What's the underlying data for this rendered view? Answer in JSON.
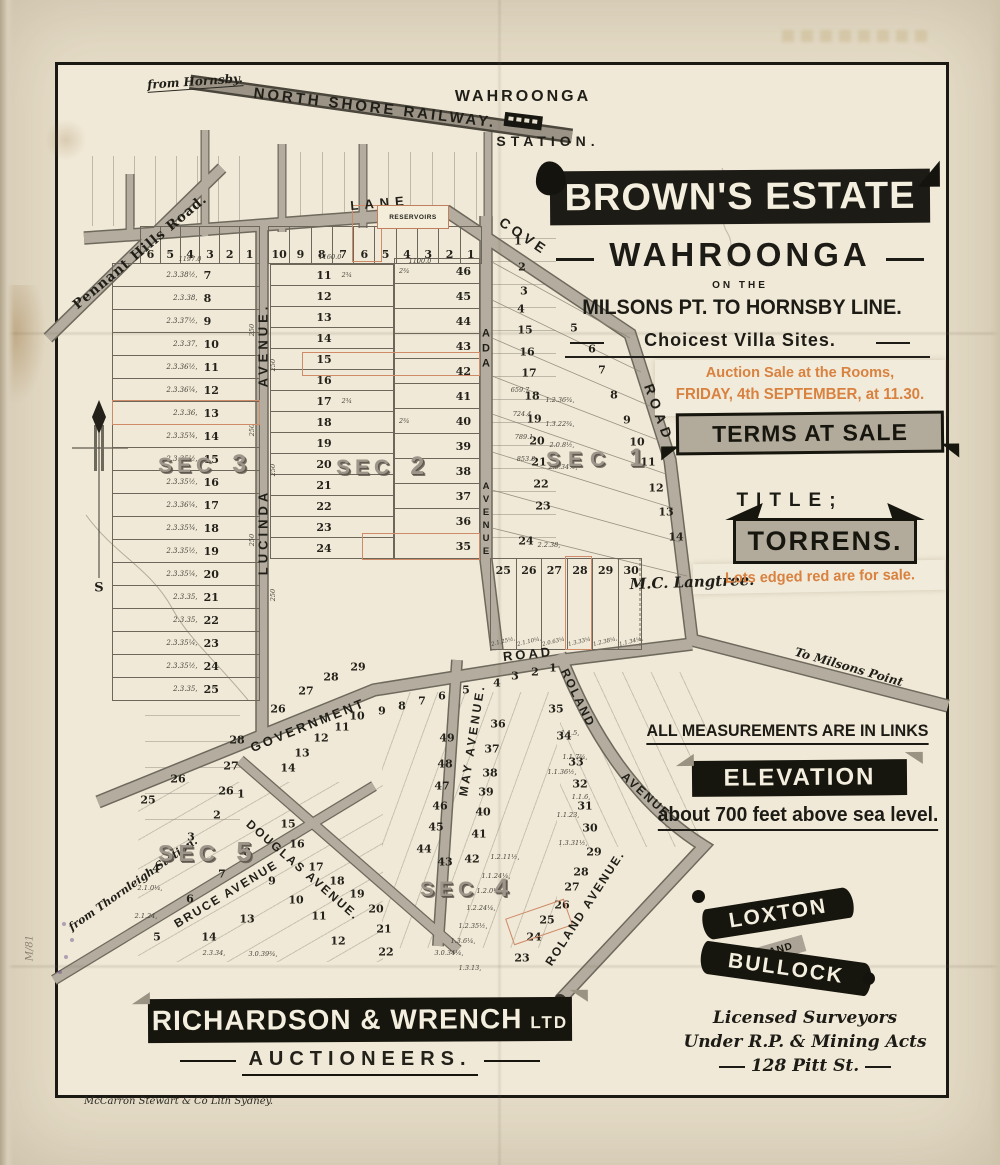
{
  "header": {
    "from_hornsby": "from Hornsby.",
    "railway": "NORTH SHORE RAILWAY.",
    "station_place": "WAHROONGA",
    "station_word": "STATION."
  },
  "title_block": {
    "estate": "BROWN'S ESTATE",
    "locality": "WAHROONGA",
    "on_the": "ON THE",
    "line": "MILSONS PT. TO HORNSBY LINE.",
    "villa": "Choicest Villa Sites.",
    "auction1": "Auction Sale at the Rooms,",
    "auction2": "FRIDAY, 4th SEPTEMBER, at 11.30.",
    "terms": "TERMS AT SALE",
    "title_word": "TITLE;",
    "torrens": "TORRENS.",
    "lots_red": "Lots edged red are for sale.",
    "accent_color": "#d9813f"
  },
  "notes": {
    "measurements": "ALL MEASUREMENTS ARE IN LINKS",
    "elevation_banner": "ELEVATION",
    "elevation_text": "about 700 feet above sea level."
  },
  "surveyors": {
    "name1": "LOXTON",
    "and": "AND",
    "name2": "BULLOCK",
    "line1": "Licensed Surveyors",
    "line2": "Under R.P. & Mining Acts",
    "line3": "128 Pitt St."
  },
  "auctioneers": {
    "firm": "RICHARDSON & WRENCH",
    "suffix": "LTD",
    "role": "AUCTIONEERS."
  },
  "imprint": "McCarron Stewart & Co Lith Sydney.",
  "margin_note": "M/81",
  "compass": {
    "south": "S"
  },
  "landowner": "M.C. Langtree.",
  "roads": {
    "pennant": "Pennant Hills Road.",
    "lane": "LANE",
    "cove": "COVE",
    "road": "ROAD",
    "milsons": "To Milsons Point",
    "lucinda1": "LUCINDA",
    "lucinda2": "AVENUE.",
    "ada1": "ADA",
    "ada2": "AVENUE",
    "government": "GOVERNMENT",
    "gov_road": "ROAD",
    "may": "MAY AVENUE.",
    "roland_a": "ROLAND",
    "roland_b": "AVENUE",
    "roland2": "ROLAND AVENUE.",
    "bruce": "BRUCE AVENUE",
    "douglas": "DOUGLAS AVENUE.",
    "thornleigh": "from Thornleigh Station.",
    "reservoirs": "RESERVOIRS"
  },
  "sections": {
    "s1": {
      "word": "SEC",
      "num": "1"
    },
    "s2": {
      "word": "SEC",
      "num": "2"
    },
    "s3": {
      "word": "SEC",
      "num": "3"
    },
    "s4": {
      "word": "SEC",
      "num": "4"
    },
    "s5": {
      "word": "SEC",
      "num": "5"
    }
  },
  "ghost": {
    "line1": "WAHROONGA",
    "line2": "BROWN'S ESTATE"
  },
  "lots": {
    "strip_left": [
      {
        "n": "6"
      },
      {
        "n": "5"
      },
      {
        "n": "4"
      },
      {
        "n": "3"
      },
      {
        "n": "2"
      },
      {
        "n": "1"
      }
    ],
    "strip_mid": [
      {
        "n": "10"
      },
      {
        "n": "9"
      },
      {
        "n": "8"
      },
      {
        "n": "7"
      },
      {
        "n": "6"
      },
      {
        "n": "5"
      },
      {
        "n": "4"
      },
      {
        "n": "3"
      },
      {
        "n": "2"
      },
      {
        "n": "1"
      }
    ],
    "sec3_rows": [
      {
        "d": "2.3.38½,",
        "n": "7"
      },
      {
        "d": "2.3.38,",
        "n": "8"
      },
      {
        "d": "2.3.37½,",
        "n": "9"
      },
      {
        "d": "2.3.37,",
        "n": "10"
      },
      {
        "d": "2.3.36½,",
        "n": "11"
      },
      {
        "d": "2.3.36¼,",
        "n": "12"
      },
      {
        "d": "2.3.36,",
        "n": "13",
        "red": true
      },
      {
        "d": "2.3.35¾,",
        "n": "14"
      },
      {
        "d": "2.3.35½,",
        "n": "15"
      },
      {
        "d": "2.3.35½,",
        "n": "16"
      },
      {
        "d": "2.3.36¼,",
        "n": "17"
      },
      {
        "d": "2.3.35¾,",
        "n": "18"
      },
      {
        "d": "2.3.35½,",
        "n": "19"
      },
      {
        "d": "2.3.35¼,",
        "n": "20"
      },
      {
        "d": "2.3.35,",
        "n": "21"
      },
      {
        "d": "2.3.35,",
        "n": "22"
      },
      {
        "d": "2.3.35¼,",
        "n": "23"
      },
      {
        "d": "2.3.35½,",
        "n": "24"
      },
      {
        "d": "2.3.35,",
        "n": "25"
      }
    ],
    "sec2_rows": [
      {
        "n": "11",
        "d": "2¾"
      },
      {
        "n": "12"
      },
      {
        "n": "13"
      },
      {
        "n": "14"
      },
      {
        "n": "15"
      },
      {
        "n": "16"
      },
      {
        "n": "17",
        "d": "2¾"
      },
      {
        "n": "18"
      },
      {
        "n": "19"
      },
      {
        "n": "20"
      },
      {
        "n": "21"
      },
      {
        "n": "22"
      },
      {
        "n": "23"
      },
      {
        "n": "24"
      }
    ],
    "ada_col": [
      {
        "n": "46",
        "d": "2¾"
      },
      {
        "n": "45"
      },
      {
        "n": "44"
      },
      {
        "n": "43"
      },
      {
        "n": "42"
      },
      {
        "n": "41"
      },
      {
        "n": "40",
        "d": "2¾"
      },
      {
        "n": "39"
      },
      {
        "n": "38"
      },
      {
        "n": "37"
      },
      {
        "n": "36"
      },
      {
        "n": "35"
      }
    ],
    "row25_30": [
      {
        "n": "25",
        "d": "2.1.25½,"
      },
      {
        "n": "26",
        "d": "2.1.10¼,"
      },
      {
        "n": "27",
        "d": "2.0.63¼,"
      },
      {
        "n": "28",
        "d": "1.3.33¼,"
      },
      {
        "n": "29",
        "d": "1.2.38¼,"
      },
      {
        "n": "30",
        "d": "1.1.34¼,"
      }
    ],
    "sec1_scatter": [
      {
        "n": "1",
        "x": 518,
        "y": 241
      },
      {
        "n": "2",
        "x": 522,
        "y": 267
      },
      {
        "n": "3",
        "x": 524,
        "y": 291
      },
      {
        "n": "4",
        "x": 521,
        "y": 309
      },
      {
        "n": "15",
        "x": 525,
        "y": 330
      },
      {
        "n": "16",
        "x": 527,
        "y": 352
      },
      {
        "n": "17",
        "x": 529,
        "y": 373
      },
      {
        "n": "18",
        "x": 532,
        "y": 396
      },
      {
        "n": "19",
        "x": 534,
        "y": 419
      },
      {
        "n": "20",
        "x": 537,
        "y": 441
      },
      {
        "n": "21",
        "x": 539,
        "y": 462
      },
      {
        "n": "22",
        "x": 541,
        "y": 484
      },
      {
        "n": "23",
        "x": 543,
        "y": 506
      },
      {
        "n": "24",
        "x": 526,
        "y": 541
      },
      {
        "n": "5",
        "x": 574,
        "y": 328
      },
      {
        "n": "6",
        "x": 592,
        "y": 349
      },
      {
        "n": "7",
        "x": 602,
        "y": 370
      },
      {
        "n": "8",
        "x": 614,
        "y": 395
      },
      {
        "n": "9",
        "x": 627,
        "y": 420
      },
      {
        "n": "10",
        "x": 637,
        "y": 442
      },
      {
        "n": "11",
        "x": 648,
        "y": 462
      },
      {
        "n": "12",
        "x": 656,
        "y": 488
      },
      {
        "n": "13",
        "x": 666,
        "y": 512
      },
      {
        "n": "14",
        "x": 676,
        "y": 537
      }
    ],
    "south_scatter": [
      {
        "n": "29",
        "x": 358,
        "y": 667
      },
      {
        "n": "28",
        "x": 331,
        "y": 677
      },
      {
        "n": "27",
        "x": 306,
        "y": 691
      },
      {
        "n": "26",
        "x": 278,
        "y": 709
      },
      {
        "n": "28",
        "x": 237,
        "y": 740
      },
      {
        "n": "27",
        "x": 231,
        "y": 766
      },
      {
        "n": "26",
        "x": 226,
        "y": 791
      },
      {
        "n": "1",
        "x": 553,
        "y": 668
      },
      {
        "n": "2",
        "x": 535,
        "y": 672
      },
      {
        "n": "3",
        "x": 515,
        "y": 676
      },
      {
        "n": "4",
        "x": 497,
        "y": 683
      },
      {
        "n": "5",
        "x": 466,
        "y": 690
      },
      {
        "n": "6",
        "x": 442,
        "y": 696
      },
      {
        "n": "7",
        "x": 422,
        "y": 701
      },
      {
        "n": "8",
        "x": 402,
        "y": 706
      },
      {
        "n": "9",
        "x": 382,
        "y": 711
      },
      {
        "n": "10",
        "x": 357,
        "y": 716
      },
      {
        "n": "11",
        "x": 342,
        "y": 727
      },
      {
        "n": "12",
        "x": 321,
        "y": 738
      },
      {
        "n": "13",
        "x": 302,
        "y": 753
      },
      {
        "n": "14",
        "x": 288,
        "y": 768
      },
      {
        "n": "49",
        "x": 447,
        "y": 738
      },
      {
        "n": "48",
        "x": 445,
        "y": 764
      },
      {
        "n": "47",
        "x": 442,
        "y": 786
      },
      {
        "n": "46",
        "x": 440,
        "y": 806
      },
      {
        "n": "45",
        "x": 436,
        "y": 827
      },
      {
        "n": "44",
        "x": 424,
        "y": 849
      },
      {
        "n": "43",
        "x": 445,
        "y": 862
      },
      {
        "n": "42",
        "x": 472,
        "y": 859
      },
      {
        "n": "41",
        "x": 479,
        "y": 834
      },
      {
        "n": "36",
        "x": 498,
        "y": 724
      },
      {
        "n": "37",
        "x": 492,
        "y": 749
      },
      {
        "n": "38",
        "x": 490,
        "y": 773
      },
      {
        "n": "39",
        "x": 486,
        "y": 792
      },
      {
        "n": "40",
        "x": 483,
        "y": 812
      },
      {
        "n": "35",
        "x": 556,
        "y": 709
      },
      {
        "n": "34",
        "x": 564,
        "y": 736
      },
      {
        "n": "33",
        "x": 576,
        "y": 762
      },
      {
        "n": "32",
        "x": 580,
        "y": 784
      },
      {
        "n": "31",
        "x": 585,
        "y": 806
      },
      {
        "n": "30",
        "x": 590,
        "y": 828
      },
      {
        "n": "29",
        "x": 594,
        "y": 852
      },
      {
        "n": "28",
        "x": 581,
        "y": 872
      },
      {
        "n": "27",
        "x": 572,
        "y": 887
      },
      {
        "n": "26",
        "x": 562,
        "y": 905
      },
      {
        "n": "25",
        "x": 547,
        "y": 920
      },
      {
        "n": "24",
        "x": 534,
        "y": 937
      },
      {
        "n": "23",
        "x": 522,
        "y": 958
      },
      {
        "n": "26",
        "x": 178,
        "y": 779
      },
      {
        "n": "25",
        "x": 148,
        "y": 800
      },
      {
        "n": "1",
        "x": 241,
        "y": 794
      },
      {
        "n": "2",
        "x": 217,
        "y": 815
      },
      {
        "n": "3",
        "x": 191,
        "y": 837
      },
      {
        "n": "4",
        "x": 156,
        "y": 869
      },
      {
        "n": "5",
        "x": 157,
        "y": 937
      },
      {
        "n": "6",
        "x": 190,
        "y": 899
      },
      {
        "n": "7",
        "x": 222,
        "y": 874
      },
      {
        "n": "8",
        "x": 247,
        "y": 852
      },
      {
        "n": "13",
        "x": 247,
        "y": 919
      },
      {
        "n": "14",
        "x": 209,
        "y": 937
      },
      {
        "n": "9",
        "x": 272,
        "y": 881
      },
      {
        "n": "10",
        "x": 296,
        "y": 900
      },
      {
        "n": "11",
        "x": 319,
        "y": 916
      },
      {
        "n": "12",
        "x": 338,
        "y": 941
      },
      {
        "n": "15",
        "x": 288,
        "y": 824
      },
      {
        "n": "16",
        "x": 297,
        "y": 844
      },
      {
        "n": "17",
        "x": 316,
        "y": 867
      },
      {
        "n": "18",
        "x": 337,
        "y": 881
      },
      {
        "n": "19",
        "x": 357,
        "y": 894
      },
      {
        "n": "20",
        "x": 376,
        "y": 909
      },
      {
        "n": "21",
        "x": 384,
        "y": 929
      },
      {
        "n": "22",
        "x": 386,
        "y": 952
      }
    ],
    "tiny_marks": [
      {
        "t": "1197.0",
        "x": 190,
        "y": 259
      },
      {
        "t": "1160.0",
        "x": 330,
        "y": 257
      },
      {
        "t": "1100.0",
        "x": 420,
        "y": 261
      },
      {
        "t": "659.7",
        "x": 520,
        "y": 390
      },
      {
        "t": "724.4",
        "x": 522,
        "y": 414
      },
      {
        "t": "789.1",
        "x": 524,
        "y": 437
      },
      {
        "t": "853.8",
        "x": 526,
        "y": 459
      },
      {
        "t": "1.2.36¾,",
        "x": 560,
        "y": 400
      },
      {
        "t": "1.3.22¾,",
        "x": 560,
        "y": 424
      },
      {
        "t": "2.0.8½,",
        "x": 562,
        "y": 445
      },
      {
        "t": "2.0.34½,",
        "x": 563,
        "y": 467
      },
      {
        "t": "2.2.38,",
        "x": 549,
        "y": 545
      },
      {
        "t": "250",
        "x": 252,
        "y": 330,
        "r": -90
      },
      {
        "t": "250",
        "x": 273,
        "y": 365,
        "r": -90
      },
      {
        "t": "250",
        "x": 252,
        "y": 430,
        "r": -90
      },
      {
        "t": "250",
        "x": 273,
        "y": 470,
        "r": -90
      },
      {
        "t": "250",
        "x": 252,
        "y": 540,
        "r": -90
      },
      {
        "t": "250",
        "x": 273,
        "y": 595,
        "r": -90
      },
      {
        "t": "2.1.0¼,",
        "x": 150,
        "y": 888
      },
      {
        "t": "2.1.24,",
        "x": 146,
        "y": 916
      },
      {
        "t": "2.3.34,",
        "x": 214,
        "y": 953
      },
      {
        "t": "3.0.39¾,",
        "x": 263,
        "y": 954
      },
      {
        "t": "3.0.34¼,",
        "x": 449,
        "y": 953
      },
      {
        "t": "1.3.13,",
        "x": 470,
        "y": 968
      },
      {
        "t": "1.2.11½,",
        "x": 505,
        "y": 857
      },
      {
        "t": "1.1.24¼,",
        "x": 496,
        "y": 876
      },
      {
        "t": "1.2.0¼,",
        "x": 489,
        "y": 891
      },
      {
        "t": "1.2.24¼,",
        "x": 481,
        "y": 908
      },
      {
        "t": "1.2.35½,",
        "x": 473,
        "y": 926
      },
      {
        "t": "1.3.6¼,",
        "x": 463,
        "y": 941
      },
      {
        "t": "1.1.5,",
        "x": 570,
        "y": 733
      },
      {
        "t": "1.1.7¾,",
        "x": 575,
        "y": 757
      },
      {
        "t": "1.1.36½,",
        "x": 562,
        "y": 772
      },
      {
        "t": "1.1.6,",
        "x": 581,
        "y": 797
      },
      {
        "t": "1.1.23,",
        "x": 568,
        "y": 815
      },
      {
        "t": "1.3.31½,",
        "x": 573,
        "y": 843
      }
    ]
  }
}
